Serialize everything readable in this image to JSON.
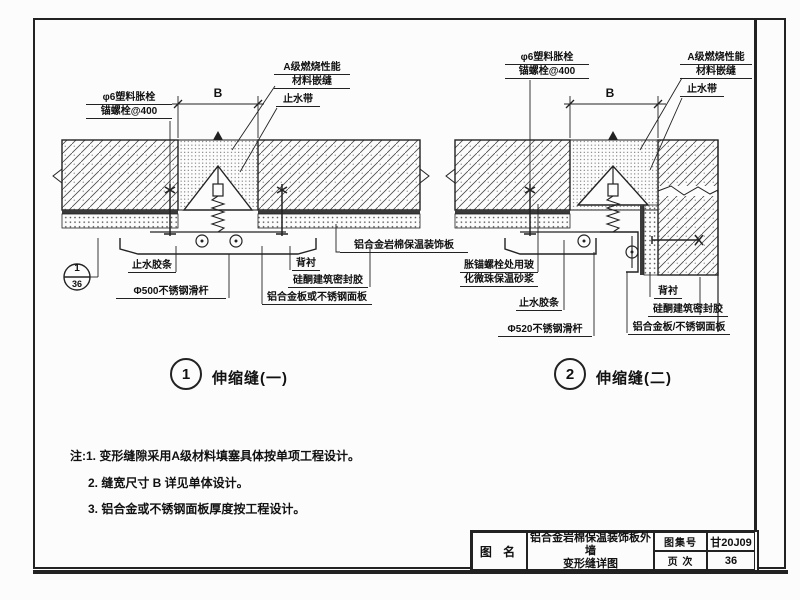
{
  "sheet": {
    "title_block": {
      "name_label": "图 名",
      "title_line1": "铝合金岩棉保温装饰板外墙",
      "title_line2": "变形缝详图",
      "atlas_label": "图集号",
      "atlas_no": "甘20J09",
      "page_label": "页 次",
      "page_no": "36"
    },
    "notes": {
      "line1": "注:1. 变形缝隙采用A级材料填塞具体按单项工程设计。",
      "line2": "2. 缝宽尺寸 B 详见单体设计。",
      "line3": "3. 铝合金或不锈钢面板厚度按工程设计。"
    }
  },
  "diagram1": {
    "number": "1",
    "caption": "伸缩缝(一)",
    "dim_b": "B",
    "callout": {
      "top": "1",
      "bottom": "36"
    },
    "labels": {
      "anchor1": "φ6塑料胀栓",
      "anchor2": "锚螺栓@400",
      "classA1": "A级燃烧性能",
      "classA2": "材料嵌缝",
      "waterstop": "止水带",
      "rubber": "止水胶条",
      "rod": "Φ500不锈钢滑杆",
      "backing": "背衬",
      "sealant": "硅酮建筑密封胶",
      "panel": "铝合金板或不锈钢面板",
      "board": "铝合金岩棉保温装饰板"
    }
  },
  "diagram2": {
    "number": "2",
    "caption": "伸缩缝(二)",
    "dim_b": "B",
    "labels": {
      "anchor1": "φ6塑料胀栓",
      "anchor2": "锚螺栓@400",
      "classA1": "A级燃烧性能",
      "classA2": "材料嵌缝",
      "waterstop": "止水带",
      "mortar1": "胀锚螺栓处用玻",
      "mortar2": "化微珠保温砂浆",
      "rubber": "止水胶条",
      "rod": "Φ520不锈钢滑杆",
      "backing": "背衬",
      "sealant": "硅酮建筑密封胶",
      "panel": "铝合金板/不锈钢面板"
    }
  },
  "colors": {
    "line": "#222222",
    "paper": "#fcfcfc"
  }
}
